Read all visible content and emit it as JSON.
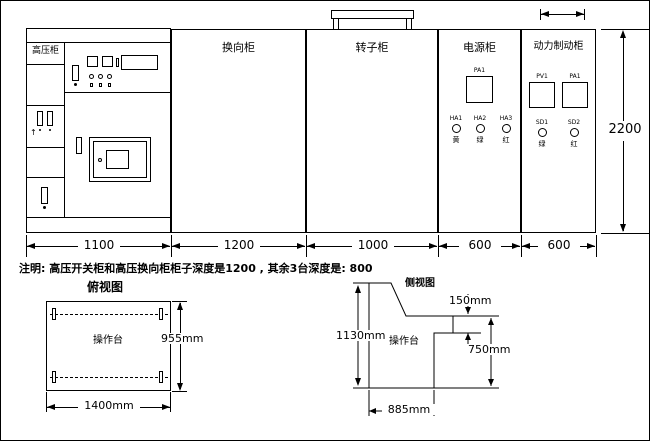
{
  "icons": {
    "up_arrow": "↑"
  },
  "cabinets": {
    "high_voltage": {
      "label": "高压柜"
    },
    "reversing": {
      "label": "换向柜"
    },
    "rotor": {
      "label": "转子柜"
    },
    "power": {
      "label": "电源柜",
      "meter": "PA1",
      "lamps": [
        {
          "tag": "HA1",
          "color_char": "黄"
        },
        {
          "tag": "HA2",
          "color_char": "绿"
        },
        {
          "tag": "HA3",
          "color_char": "红"
        }
      ]
    },
    "dynamic_brake": {
      "label": "动力制动柜",
      "meters": [
        "PV1",
        "PA1"
      ],
      "lamps": [
        {
          "tag": "SD1",
          "color_char": "绿"
        },
        {
          "tag": "SD2",
          "color_char": "红"
        }
      ]
    }
  },
  "dims": {
    "widths": [
      "1100",
      "1200",
      "1000",
      "600",
      "600"
    ],
    "height": "2200"
  },
  "note": "注明: 高压开关柜和高压换向柜柜子深度是1200 , 其余3台深度是: 800",
  "top_view": {
    "title": "俯视图",
    "label": "操作台",
    "width": "1400mm",
    "depth": "955mm"
  },
  "side_view": {
    "title": "侧视图",
    "label": "操作台",
    "height": "1130mm",
    "step": "150mm",
    "desk_height": "750mm",
    "base_width": "885mm"
  }
}
